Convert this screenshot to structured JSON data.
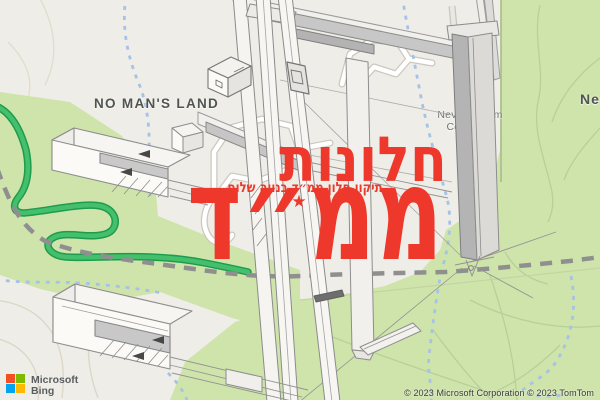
{
  "map": {
    "labels": {
      "no_mans_land": "NO MAN'S LAND",
      "cemetery_line1": "Neve Shalom",
      "cemetery_line2": "Cemetery",
      "region_partial": "Ne"
    },
    "colors": {
      "land": "#efede7",
      "greenery": "#cfe4ab",
      "highway_green": "#44c06d",
      "highway_casing": "#1f9b4e",
      "boundary_dash_gray": "#8f8f8f",
      "stream_dash_blue": "#a7c2e7"
    }
  },
  "watermark": {
    "color": "#ee382b",
    "line1": "חלונות",
    "line2": "ממ״ד",
    "subtitle": "תיקון חלון ממ״ד בנווה שלום",
    "star": "★"
  },
  "branding": {
    "name_line1": "Microsoft",
    "name_line2": "Bing",
    "square_colors": {
      "top_left": "#f25022",
      "top_right": "#7fba00",
      "bottom_left": "#00a4ef",
      "bottom_right": "#ffb900"
    }
  },
  "attribution": {
    "text": "© 2023 Microsoft Corporation © 2023 TomTom"
  }
}
